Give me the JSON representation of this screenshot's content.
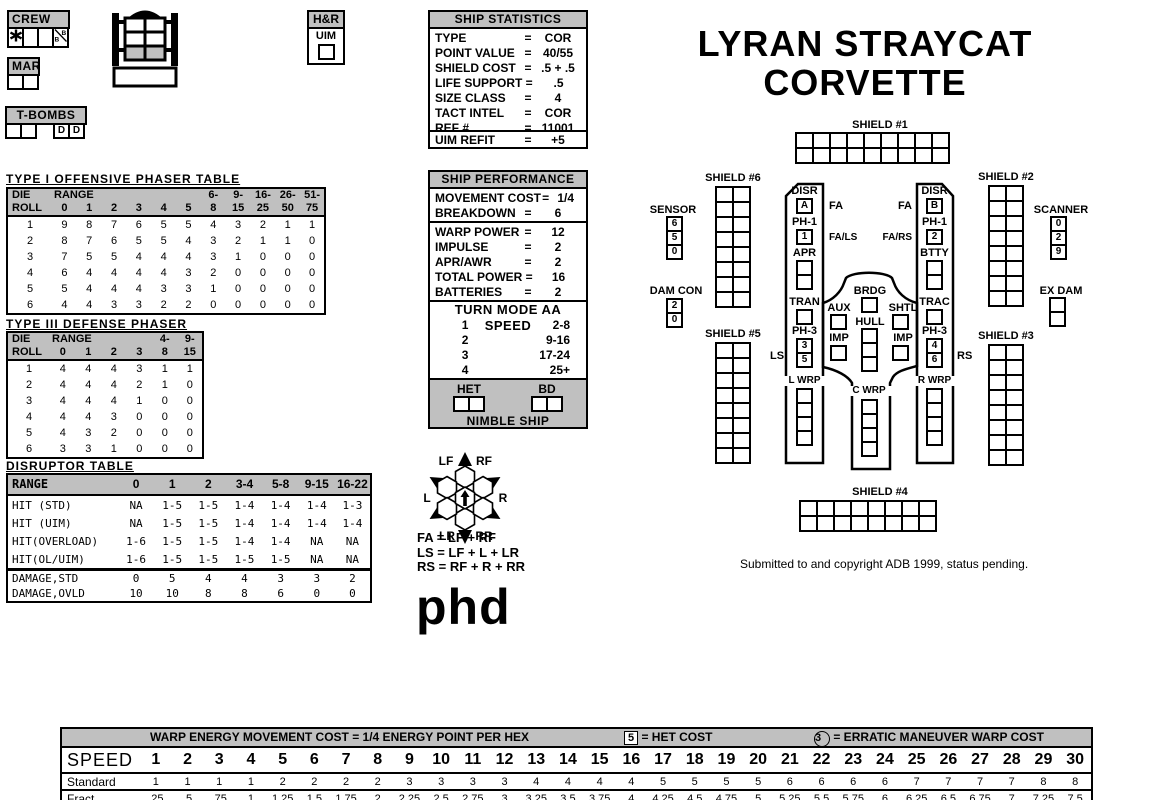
{
  "eq_sign": "=",
  "title": {
    "line1": "LYRAN STRAYCAT",
    "line2": "CORVETTE"
  },
  "colors": {
    "gray": "#C0C0C0",
    "black": "#000000",
    "white": "#FFFFFF"
  },
  "top_left": {
    "crew": {
      "label": "CREW"
    },
    "mar": {
      "label": "MAR",
      "boxes": 2
    },
    "tbombs": {
      "label": "T-BOMBS",
      "plain_boxes": 2,
      "d_cells": [
        "D",
        "D"
      ]
    },
    "hr": {
      "label": "H&R",
      "uim": "UIM",
      "boxes": 1
    }
  },
  "ship_statistics": {
    "title": "SHIP STATISTICS",
    "rows": [
      {
        "label": "TYPE",
        "value": "COR"
      },
      {
        "label": "POINT VALUE",
        "value": "40/55"
      },
      {
        "label": "SHIELD COST",
        "value": ".5 + .5"
      },
      {
        "label": "LIFE SUPPORT",
        "value": ".5"
      },
      {
        "label": "SIZE CLASS",
        "value": "4"
      },
      {
        "label": "TACT INTEL",
        "value": "COR"
      },
      {
        "label": "REF #",
        "value": "11001"
      }
    ],
    "refit": {
      "label": "UIM REFIT",
      "value": "+5"
    }
  },
  "ship_performance": {
    "title": "SHIP PERFORMANCE",
    "movement": [
      {
        "label": "MOVEMENT COST",
        "value": "1/4"
      },
      {
        "label": "BREAKDOWN",
        "value": "6"
      }
    ],
    "power": [
      {
        "label": "WARP POWER",
        "value": "12"
      },
      {
        "label": "IMPULSE",
        "value": "2"
      },
      {
        "label": "APR/AWR",
        "value": "2"
      },
      {
        "label": "TOTAL POWER",
        "value": "16"
      },
      {
        "label": "BATTERIES",
        "value": "2"
      }
    ],
    "turn_mode": {
      "header": "TURN MODE AA SPEED",
      "rows": [
        {
          "mode": "1",
          "speed": "2-8"
        },
        {
          "mode": "2",
          "speed": "9-16"
        },
        {
          "mode": "3",
          "speed": "17-24"
        },
        {
          "mode": "4",
          "speed": "25+"
        }
      ]
    },
    "het_label": "HET",
    "het_boxes": 2,
    "bd_label": "BD",
    "bd_boxes": 2,
    "nimble": "NIMBLE SHIP"
  },
  "phaser1_table": {
    "title": "TYPE I OFFENSIVE PHASER TABLE",
    "header_top": [
      "DIE",
      "RANGE",
      "",
      "",
      "",
      "",
      "",
      "6-",
      "9-",
      "16-",
      "26-",
      "51-"
    ],
    "header_bot": [
      "ROLL",
      "0",
      "1",
      "2",
      "3",
      "4",
      "5",
      "8",
      "15",
      "25",
      "50",
      "75"
    ],
    "rows": [
      [
        "1",
        9,
        8,
        7,
        6,
        5,
        5,
        4,
        3,
        2,
        1,
        1
      ],
      [
        "2",
        8,
        7,
        6,
        5,
        5,
        4,
        3,
        2,
        1,
        1,
        0
      ],
      [
        "3",
        7,
        5,
        5,
        4,
        4,
        4,
        3,
        1,
        0,
        0,
        0
      ],
      [
        "4",
        6,
        4,
        4,
        4,
        4,
        3,
        2,
        0,
        0,
        0,
        0
      ],
      [
        "5",
        5,
        4,
        4,
        4,
        3,
        3,
        1,
        0,
        0,
        0,
        0
      ],
      [
        "6",
        4,
        4,
        3,
        3,
        2,
        2,
        0,
        0,
        0,
        0,
        0
      ]
    ]
  },
  "phaser3_table": {
    "title": "TYPE III DEFENSE PHASER",
    "header_top": [
      "DIE",
      "RANGE",
      "",
      "",
      "",
      "4-",
      "9-"
    ],
    "header_bot": [
      "ROLL",
      "0",
      "1",
      "2",
      "3",
      "8",
      "15"
    ],
    "rows": [
      [
        "1",
        4,
        4,
        4,
        3,
        1,
        1
      ],
      [
        "2",
        4,
        4,
        4,
        2,
        1,
        0
      ],
      [
        "3",
        4,
        4,
        4,
        1,
        0,
        0
      ],
      [
        "4",
        4,
        4,
        3,
        0,
        0,
        0
      ],
      [
        "5",
        4,
        3,
        2,
        0,
        0,
        0
      ],
      [
        "6",
        3,
        3,
        1,
        0,
        0,
        0
      ]
    ]
  },
  "disruptor_table": {
    "title": "DISRUPTOR TABLE",
    "header": [
      "RANGE",
      "0",
      "1",
      "2",
      "3-4",
      "5-8",
      "9-15",
      "16-22"
    ],
    "hit_rows": [
      [
        "HIT (STD)",
        "NA",
        "1-5",
        "1-5",
        "1-4",
        "1-4",
        "1-4",
        "1-3"
      ],
      [
        "HIT (UIM)",
        "NA",
        "1-5",
        "1-5",
        "1-4",
        "1-4",
        "1-4",
        "1-4"
      ],
      [
        "HIT(OVERLOAD)",
        "1-6",
        "1-5",
        "1-5",
        "1-4",
        "1-4",
        "NA",
        "NA"
      ],
      [
        "HIT(OL/UIM)",
        "1-6",
        "1-5",
        "1-5",
        "1-5",
        "1-5",
        "NA",
        "NA"
      ]
    ],
    "damage_rows": [
      [
        "DAMAGE,STD",
        "0",
        "5",
        "4",
        "4",
        "3",
        "3",
        "2"
      ],
      [
        "DAMAGE,OVLD",
        "10",
        "10",
        "8",
        "8",
        "6",
        "0",
        "0"
      ]
    ]
  },
  "firing_arcs": {
    "rose_labels": {
      "lf": "LF",
      "rf": "RF",
      "l": "L",
      "r": "R",
      "lr": "LR",
      "rr": "RR"
    },
    "legend": [
      "FA = LF + RF",
      "LS = LF + L + LR",
      "RS = RF + R + RR"
    ],
    "phd": "phd"
  },
  "ship_diagram": {
    "shield1": {
      "label": "SHIELD #1",
      "cols": 9,
      "rows": 2
    },
    "shield2": {
      "label": "SHIELD #2",
      "cols": 2,
      "rows": 8
    },
    "shield3": {
      "label": "SHIELD #3",
      "cols": 2,
      "rows": 8
    },
    "shield4": {
      "label": "SHIELD #4",
      "cols": 8,
      "rows": 2
    },
    "shield5": {
      "label": "SHIELD #5",
      "cols": 2,
      "rows": 8
    },
    "shield6": {
      "label": "SHIELD #6",
      "cols": 2,
      "rows": 8
    },
    "sensor": {
      "label": "SENSOR",
      "values": [
        "6",
        "5",
        "0"
      ]
    },
    "dam_con": {
      "label": "DAM CON",
      "values": [
        "2",
        "0"
      ]
    },
    "scanner": {
      "label": "SCANNER",
      "values": [
        "0",
        "2",
        "9"
      ]
    },
    "ex_dam": {
      "label": "EX DAM",
      "boxes": 2
    },
    "left": {
      "disr": "DISR",
      "disr_box": [
        "A"
      ],
      "arc_disr": "FA",
      "ph1": "PH-1",
      "ph1_box": [
        "1"
      ],
      "arc_ph1": "FA/LS",
      "apr": "APR",
      "apr_boxes": 2,
      "tran": "TRAN",
      "tran_boxes": 1,
      "ph3": "PH-3",
      "ph3_boxes": [
        "3",
        "5"
      ],
      "arc_ph3": "LS",
      "wrp": "L WRP",
      "wrp_boxes": 4
    },
    "right": {
      "disr": "DISR",
      "disr_box": [
        "B"
      ],
      "arc_disr": "FA",
      "ph1": "PH-1",
      "ph1_box": [
        "2"
      ],
      "arc_ph1": "FA/RS",
      "btty": "BTTY",
      "btty_boxes": 2,
      "trac": "TRAC",
      "trac_boxes": 1,
      "ph3": "PH-3",
      "ph3_boxes": [
        "4",
        "6"
      ],
      "arc_ph3": "RS",
      "wrp": "R WRP",
      "wrp_boxes": 4
    },
    "center": {
      "brdg": "BRDG",
      "brdg_boxes": 1,
      "aux": "AUX",
      "aux_boxes": 1,
      "shtl": "SHTL",
      "shtl_boxes": 1,
      "hull": "HULL",
      "hull_boxes": 3,
      "imp": "IMP",
      "imp_boxes": 1,
      "wrp": "C WRP",
      "wrp_boxes": 4
    },
    "copyright": "Submitted to and copyright ADB 1999, status pending."
  },
  "energy_table": {
    "header_left": "WARP ENERGY MOVEMENT COST = 1/4 ENERGY POINT PER HEX",
    "het_symbol": "5",
    "header_het": "= HET COST",
    "em_symbol": "3",
    "header_em": "= ERRATIC MANEUVER WARP COST",
    "speed_label": "SPEED",
    "standard_label": "Standard",
    "fract_label": "Fract.",
    "speeds": [
      "1",
      "2",
      "3",
      "4",
      "5",
      "6",
      "7",
      "8",
      "9",
      "10",
      "11",
      "12",
      "13",
      "14",
      "15",
      "16",
      "17",
      "18",
      "19",
      "20",
      "21",
      "22",
      "23",
      "24",
      "25",
      "26",
      "27",
      "28",
      "29",
      "30"
    ],
    "standard": [
      "1",
      "1",
      "1",
      "1",
      "2",
      "2",
      "2",
      "2",
      "3",
      "3",
      "3",
      "3",
      "4",
      "4",
      "4",
      "4",
      "5",
      "5",
      "5",
      "5",
      "6",
      "6",
      "6",
      "6",
      "7",
      "7",
      "7",
      "7",
      "8",
      "8"
    ],
    "fract": [
      ".25",
      ".5",
      ".75",
      "1",
      "1.25",
      "1.5",
      "1.75",
      "2",
      "2.25",
      "2.5",
      "2.75",
      "3",
      "3.25",
      "3.5",
      "3.75",
      "4",
      "4.25",
      "4.5",
      "4.75",
      "5",
      "5.25",
      "5.5",
      "5.75",
      "6",
      "6.25",
      "6.5",
      "6.75",
      "7",
      "7.25",
      "7.5"
    ]
  }
}
